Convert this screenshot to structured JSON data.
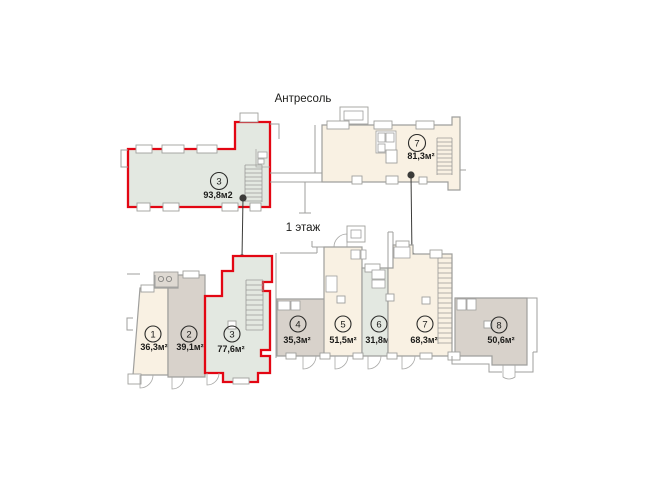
{
  "page": {
    "background": "#ffffff"
  },
  "palette": {
    "highlight_outline": "#e30613",
    "wall_line": "#9f9f9d",
    "fill_cream": "#f9f1e3",
    "fill_gray": "#d8d2cb",
    "fill_green": "#e3e8e1",
    "marker": "#3b3b39"
  },
  "floors": {
    "mezzanine": {
      "title": "Антресоль",
      "units": [
        {
          "number": "3",
          "area": "93,8м2",
          "fill": "#e3e8e1",
          "highlighted": true
        },
        {
          "number": "7",
          "area": "81,3м²",
          "fill": "#f9f1e3",
          "highlighted": false
        }
      ]
    },
    "first_floor": {
      "title": "1 этаж",
      "units": [
        {
          "number": "1",
          "area": "36,3м²",
          "fill": "#f9f1e3",
          "highlighted": false
        },
        {
          "number": "2",
          "area": "39,1м²",
          "fill": "#d8d2cb",
          "highlighted": false
        },
        {
          "number": "3",
          "area": "77,6м²",
          "fill": "#e3e8e1",
          "highlighted": true
        },
        {
          "number": "4",
          "area": "35,3м²",
          "fill": "#d8d2cb",
          "highlighted": false
        },
        {
          "number": "5",
          "area": "51,5м²",
          "fill": "#f9f1e3",
          "highlighted": false
        },
        {
          "number": "6",
          "area": "31,8м²",
          "fill": "#e3e8e1",
          "highlighted": false
        },
        {
          "number": "7",
          "area": "68,3м²",
          "fill": "#f9f1e3",
          "highlighted": false
        },
        {
          "number": "8",
          "area": "50,6м²",
          "fill": "#d8d2cb",
          "highlighted": false
        }
      ]
    }
  }
}
